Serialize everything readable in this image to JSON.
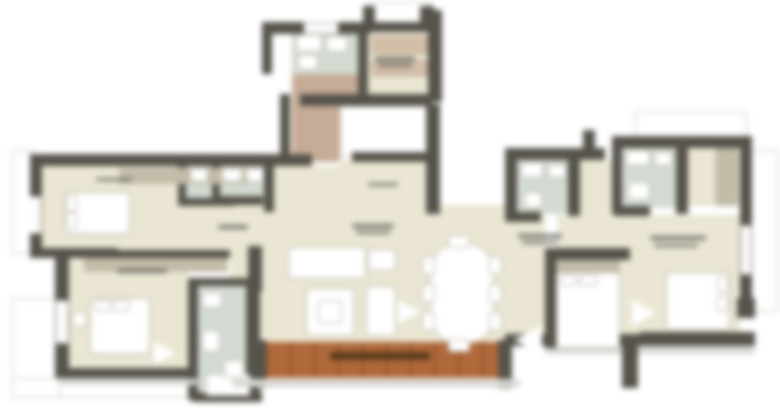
{
  "image": {
    "type": "architectural floor plan (blurred render)",
    "note": "Blurred apartment floor-plan screenshot; all room labels and dimension strings are illegible smudges, no readable text in pixels"
  },
  "colors": {
    "wall": "#56534b",
    "floor": "#eae6d3",
    "tile": "#d2dad1",
    "brown_floor": "#c6ac97",
    "deck": "#b0693a",
    "deck_label": "#4e3418",
    "outline": "#c9c7c0",
    "furniture": "#ffffff",
    "furniture_border": "#b3ada0",
    "wardrobe": "#cfc8b4",
    "counter": "#d3bfa8",
    "smudge": "#62605a",
    "shadow": "#d8d7d3",
    "background": "#ffffff"
  },
  "regions": {
    "top_block": [
      "kitchen-bathroom",
      "utility-room",
      "foyer-brown-floor",
      "stair-void"
    ],
    "left": [
      "bedroom-1",
      "bathroom-2",
      "bedroom-2",
      "bathroom-3"
    ],
    "center": [
      "living-dining-room",
      "sofa-set",
      "coffee-table",
      "dining-table",
      "wood-deck"
    ],
    "right": [
      "bathroom-4",
      "bathroom-5",
      "dressing-area",
      "bedroom-3",
      "bedroom-4",
      "entry-hall"
    ]
  }
}
